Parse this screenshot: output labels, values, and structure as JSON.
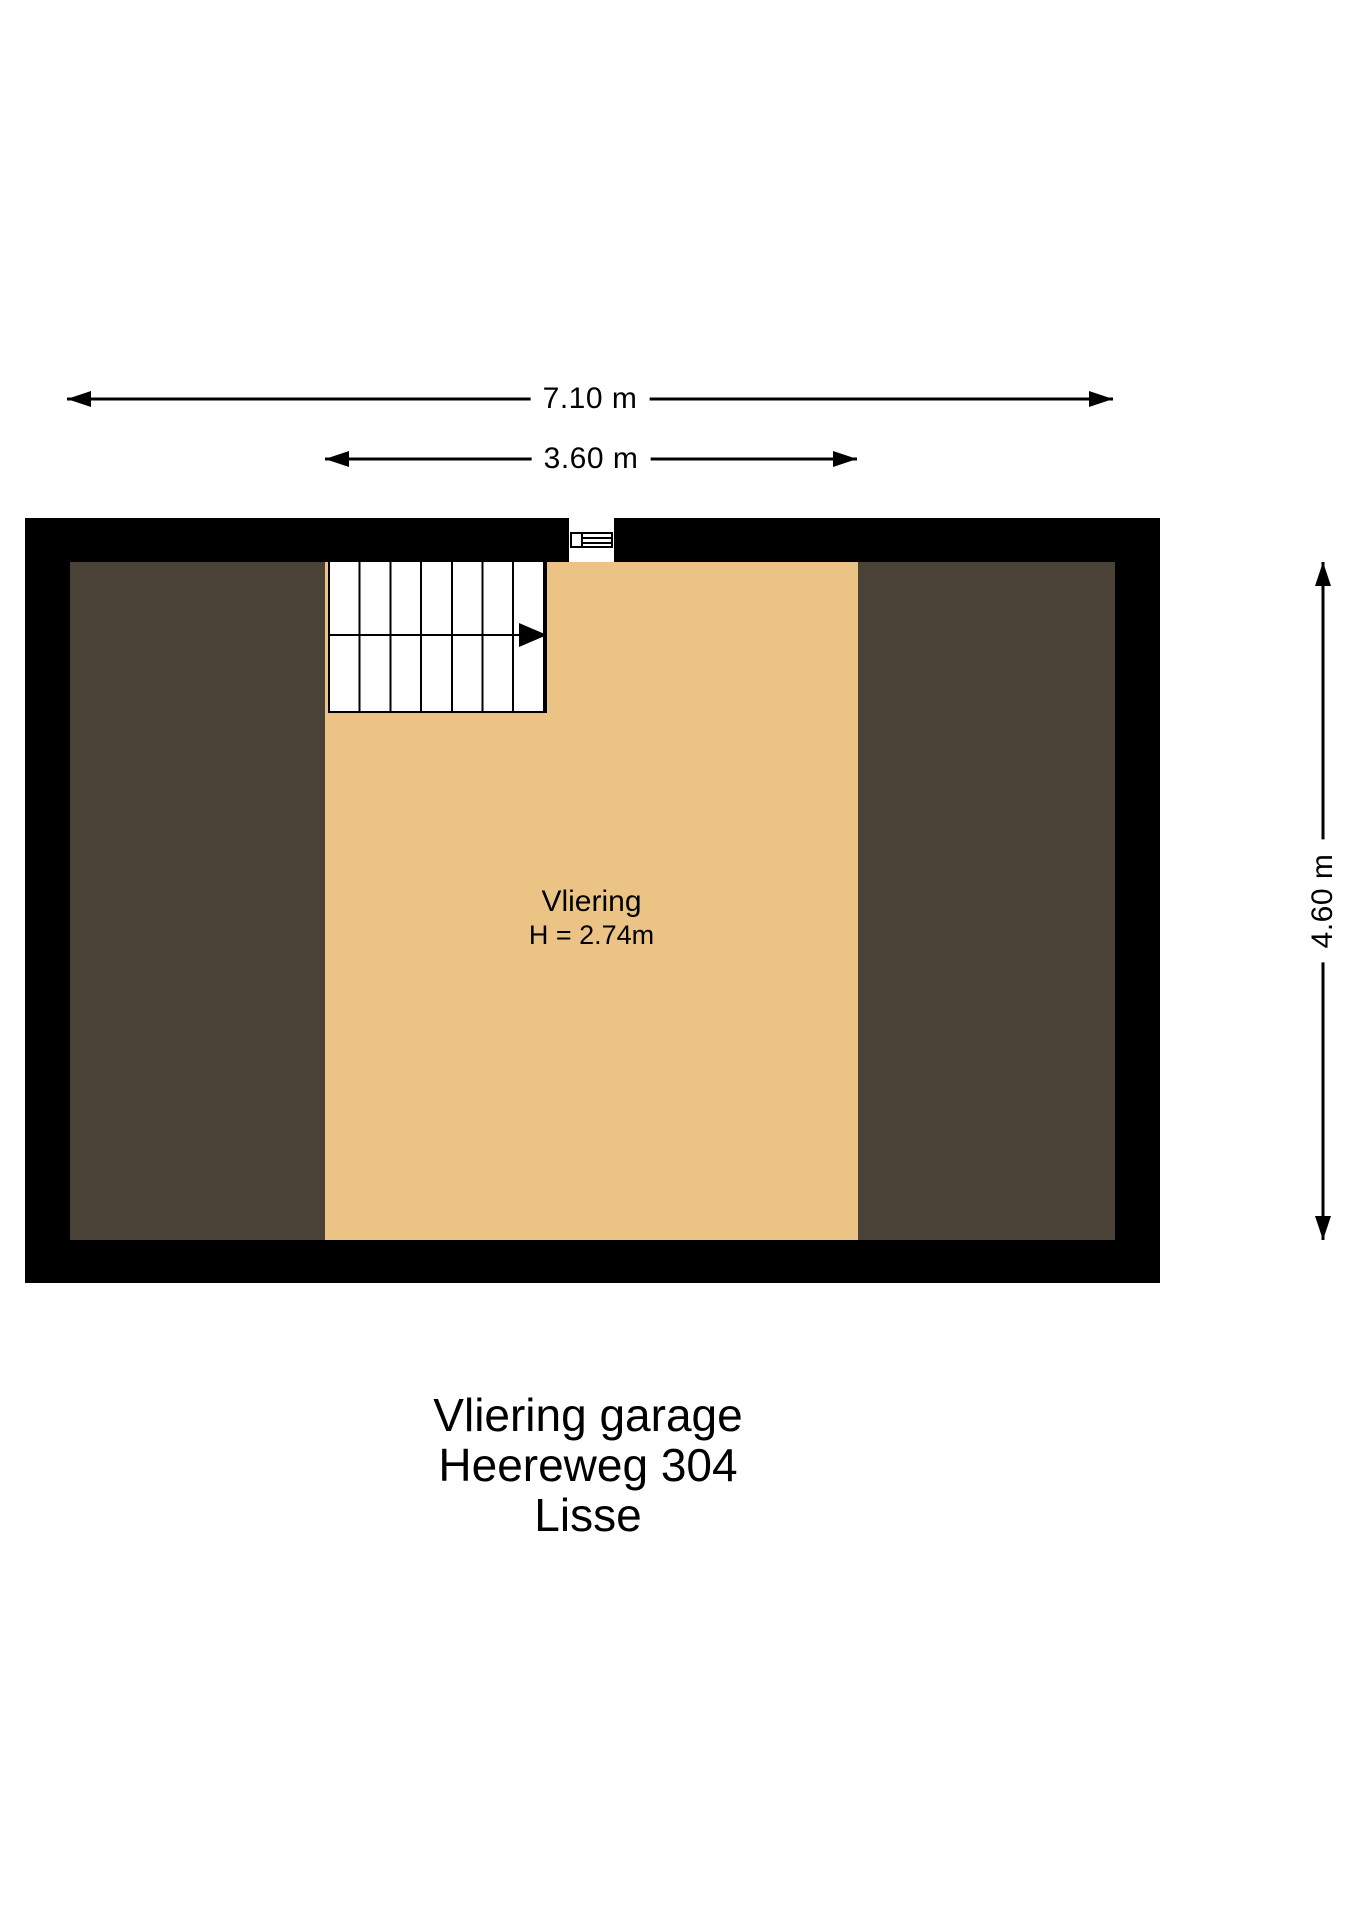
{
  "plan": {
    "type": "floorplan",
    "room": {
      "label": "Vliering",
      "height_label": "H = 2.74m"
    },
    "dimensions": {
      "total_width": "7.10 m",
      "vliering_width": "3.60 m",
      "depth": "4.60 m"
    },
    "title_block": {
      "lines": [
        "Vliering garage",
        "Heereweg 304",
        "Lisse"
      ]
    }
  },
  "colors": {
    "wall": "#000000",
    "floor": "#EBC485",
    "roof": "#4A4237",
    "background": "#FFFFFF",
    "stair": "#FFFFFF"
  }
}
